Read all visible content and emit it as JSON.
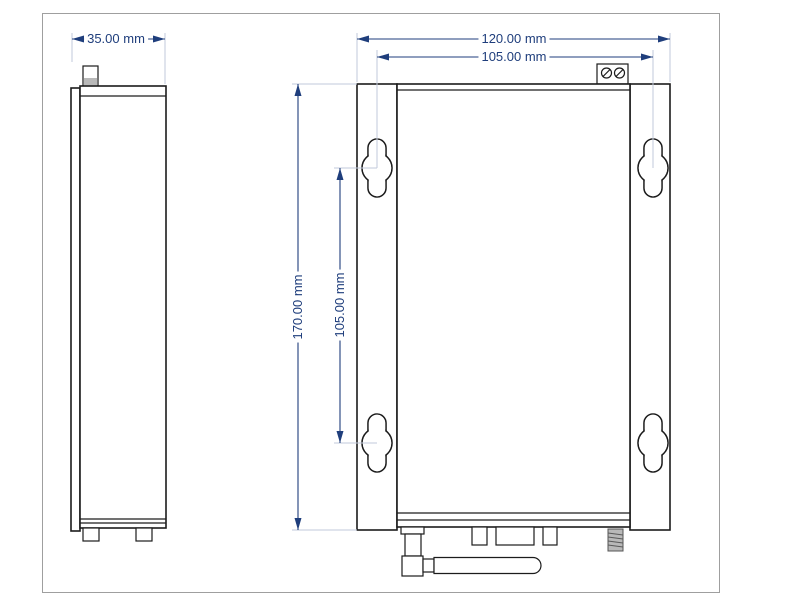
{
  "drawing": {
    "dim_side_width": "35.00 mm",
    "dim_front_width": "120.00 mm",
    "dim_mount_spacing_h": "105.00 mm",
    "dim_front_height": "170.00 mm",
    "dim_mount_spacing_v": "105.00 mm"
  },
  "watermark": {
    "brand_cn": "聚信隆诚",
    "brand_en": "JU XIN LONG CHENG"
  },
  "colors": {
    "dimension": "#1f3e7c",
    "extension_line": "#c2cadb",
    "outline": "#1c1c1c",
    "watermark": "#b3afa8",
    "frame_border": "#9f9f9f",
    "background": "#ffffff"
  }
}
